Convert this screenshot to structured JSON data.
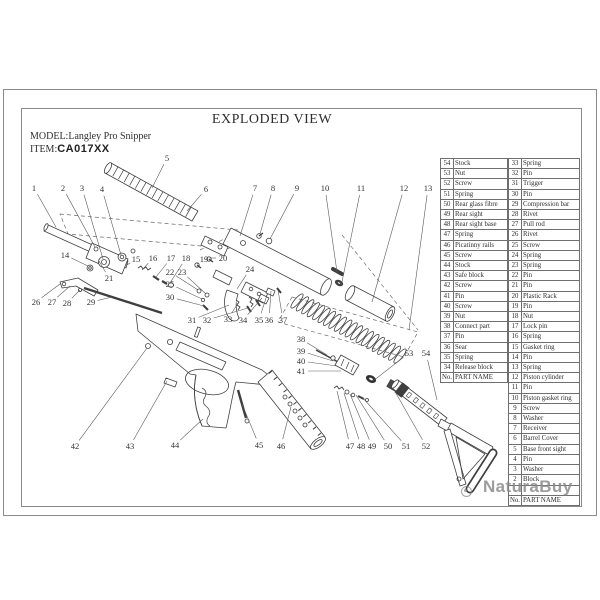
{
  "page": {
    "title": "EXPLODED VIEW",
    "model_label": "MODEL:",
    "model_value": "Langley Pro Snipper",
    "item_label": "ITEM:",
    "item_value": "CA017XX",
    "watermark": "NaturaBuy"
  },
  "colors": {
    "drawing_line": "#3f3f3f",
    "leader_line": "#5a5a5a",
    "table_border": "#6f6f6f",
    "watermark_gray": "#868686"
  },
  "parts_table": {
    "header": {
      "no": "No.",
      "name": "PART NAME"
    },
    "left_rows": [
      {
        "no": "54",
        "name": "Stock"
      },
      {
        "no": "53",
        "name": "Nut"
      },
      {
        "no": "52",
        "name": "Screw"
      },
      {
        "no": "51",
        "name": "Spring"
      },
      {
        "no": "50",
        "name": "Rear glass fibre"
      },
      {
        "no": "49",
        "name": "Rear sight"
      },
      {
        "no": "48",
        "name": "Rear sight base"
      },
      {
        "no": "47",
        "name": "Spring"
      },
      {
        "no": "46",
        "name": "Picatinny rails"
      },
      {
        "no": "45",
        "name": "Screw"
      },
      {
        "no": "44",
        "name": "Stock"
      },
      {
        "no": "43",
        "name": "Safe block"
      },
      {
        "no": "42",
        "name": "Screw"
      },
      {
        "no": "41",
        "name": "Pin"
      },
      {
        "no": "40",
        "name": "Screw"
      },
      {
        "no": "39",
        "name": "Nut"
      },
      {
        "no": "38",
        "name": "Connect part"
      },
      {
        "no": "37",
        "name": "Pin"
      },
      {
        "no": "36",
        "name": "Sear"
      },
      {
        "no": "35",
        "name": "Spring"
      },
      {
        "no": "34",
        "name": "Release block"
      }
    ],
    "right_rows": [
      {
        "no": "33",
        "name": "Spring"
      },
      {
        "no": "32",
        "name": "Pin"
      },
      {
        "no": "31",
        "name": "Trigger"
      },
      {
        "no": "30",
        "name": "Pin"
      },
      {
        "no": "29",
        "name": "Compression bar"
      },
      {
        "no": "28",
        "name": "Rivet"
      },
      {
        "no": "27",
        "name": "Pull rod"
      },
      {
        "no": "26",
        "name": "Rivet"
      },
      {
        "no": "25",
        "name": "Screw"
      },
      {
        "no": "24",
        "name": "Spring"
      },
      {
        "no": "23",
        "name": "Spring"
      },
      {
        "no": "22",
        "name": "Pin"
      },
      {
        "no": "21",
        "name": "Pin"
      },
      {
        "no": "20",
        "name": "Plastic Rack"
      },
      {
        "no": "19",
        "name": "Pin"
      },
      {
        "no": "18",
        "name": "Nut"
      },
      {
        "no": "17",
        "name": "Lock pin"
      },
      {
        "no": "16",
        "name": "Spring"
      },
      {
        "no": "15",
        "name": "Gasket ring"
      },
      {
        "no": "14",
        "name": "Pin"
      },
      {
        "no": "13",
        "name": "Spring"
      },
      {
        "no": "12",
        "name": "Piston cylinder"
      },
      {
        "no": "11",
        "name": "Pin"
      },
      {
        "no": "10",
        "name": "Piston gasket ring"
      },
      {
        "no": "9",
        "name": "Screw"
      },
      {
        "no": "8",
        "name": "Washer"
      },
      {
        "no": "7",
        "name": "Receiver"
      },
      {
        "no": "6",
        "name": "Barrel Cover"
      },
      {
        "no": "5",
        "name": "Base front sight"
      },
      {
        "no": "4",
        "name": "Pin"
      },
      {
        "no": "3",
        "name": "Washer"
      },
      {
        "no": "2",
        "name": "Block"
      },
      {
        "no": "",
        "name": ""
      }
    ]
  },
  "callouts": [
    {
      "n": "1",
      "x": 34,
      "y": 188,
      "tx": 56,
      "ty": 227
    },
    {
      "n": "2",
      "x": 63,
      "y": 188,
      "tx": 95,
      "ty": 247
    },
    {
      "n": "3",
      "x": 82,
      "y": 188,
      "tx": 103,
      "ty": 259
    },
    {
      "n": "4",
      "x": 102,
      "y": 189,
      "tx": 121,
      "ty": 255
    },
    {
      "n": "5",
      "x": 167,
      "y": 158,
      "tx": 152,
      "ty": 188
    },
    {
      "n": "6",
      "x": 206,
      "y": 189,
      "tx": 187,
      "ty": 211
    },
    {
      "n": "7",
      "x": 255,
      "y": 188,
      "tx": 240,
      "ty": 236
    },
    {
      "n": "8",
      "x": 273,
      "y": 188,
      "tx": 260,
      "ty": 234
    },
    {
      "n": "9",
      "x": 297,
      "y": 188,
      "tx": 270,
      "ty": 239
    },
    {
      "n": "10",
      "x": 325,
      "y": 188,
      "tx": 337,
      "ty": 272
    },
    {
      "n": "11",
      "x": 361,
      "y": 188,
      "tx": 342,
      "ty": 282
    },
    {
      "n": "12",
      "x": 404,
      "y": 188,
      "tx": 372,
      "ty": 302
    },
    {
      "n": "13",
      "x": 428,
      "y": 188,
      "tx": 409,
      "ty": 330
    },
    {
      "n": "14",
      "x": 65,
      "y": 255,
      "tx": 88,
      "ty": 266
    },
    {
      "n": "15",
      "x": 136,
      "y": 259,
      "tx": 127,
      "ty": 265
    },
    {
      "n": "16",
      "x": 153,
      "y": 258,
      "tx": 142,
      "ty": 270
    },
    {
      "n": "17",
      "x": 171,
      "y": 258,
      "tx": 156,
      "ty": 277
    },
    {
      "n": "18",
      "x": 186,
      "y": 258,
      "tx": 170,
      "ty": 283
    },
    {
      "n": "19",
      "x": 204,
      "y": 259,
      "tx": 197,
      "ty": 264
    },
    {
      "n": "20",
      "x": 223,
      "y": 258,
      "tx": 210,
      "ty": 258
    },
    {
      "n": "21",
      "x": 109,
      "y": 278,
      "tx": 99,
      "ty": 261
    },
    {
      "n": "22",
      "x": 170,
      "y": 272,
      "tx": 198,
      "ty": 290
    },
    {
      "n": "23",
      "x": 182,
      "y": 272,
      "tx": 206,
      "ty": 294
    },
    {
      "n": "24",
      "x": 250,
      "y": 269,
      "tx": 237,
      "ty": 289
    },
    {
      "n": "25",
      "x": 170,
      "y": 284,
      "tx": 202,
      "ty": 299
    },
    {
      "n": "26",
      "x": 36,
      "y": 302,
      "tx": 60,
      "ty": 284
    },
    {
      "n": "27",
      "x": 52,
      "y": 302,
      "tx": 70,
      "ty": 286
    },
    {
      "n": "28",
      "x": 67,
      "y": 303,
      "tx": 80,
      "ty": 290
    },
    {
      "n": "29",
      "x": 91,
      "y": 302,
      "tx": 112,
      "ty": 297
    },
    {
      "n": "30",
      "x": 170,
      "y": 297,
      "tx": 204,
      "ty": 306
    },
    {
      "n": "31",
      "x": 192,
      "y": 320,
      "tx": 229,
      "ty": 305
    },
    {
      "n": "32",
      "x": 207,
      "y": 320,
      "tx": 248,
      "ty": 308
    },
    {
      "n": "33",
      "x": 228,
      "y": 319,
      "tx": 238,
      "ty": 303
    },
    {
      "n": "34",
      "x": 243,
      "y": 320,
      "tx": 262,
      "ty": 298
    },
    {
      "n": "35",
      "x": 259,
      "y": 320,
      "tx": 267,
      "ty": 295
    },
    {
      "n": "36",
      "x": 269,
      "y": 320,
      "tx": 271,
      "ty": 291
    },
    {
      "n": "37",
      "x": 283,
      "y": 320,
      "tx": 278,
      "ty": 290
    },
    {
      "n": "38",
      "x": 301,
      "y": 339,
      "tx": 327,
      "ty": 355
    },
    {
      "n": "39",
      "x": 301,
      "y": 351,
      "tx": 333,
      "ty": 361
    },
    {
      "n": "40",
      "x": 301,
      "y": 361,
      "tx": 337,
      "ty": 366
    },
    {
      "n": "41",
      "x": 301,
      "y": 371,
      "tx": 341,
      "ty": 371
    },
    {
      "n": "42",
      "x": 75,
      "y": 446,
      "tx": 147,
      "ty": 348
    },
    {
      "n": "43",
      "x": 130,
      "y": 446,
      "tx": 167,
      "ty": 381
    },
    {
      "n": "44",
      "x": 175,
      "y": 445,
      "tx": 203,
      "ty": 419
    },
    {
      "n": "45",
      "x": 259,
      "y": 445,
      "tx": 242,
      "ty": 404
    },
    {
      "n": "46",
      "x": 281,
      "y": 446,
      "tx": 291,
      "ty": 407
    },
    {
      "n": "47",
      "x": 350,
      "y": 446,
      "tx": 337,
      "ty": 391
    },
    {
      "n": "48",
      "x": 361,
      "y": 446,
      "tx": 344,
      "ty": 393
    },
    {
      "n": "49",
      "x": 372,
      "y": 446,
      "tx": 350,
      "ty": 394
    },
    {
      "n": "50",
      "x": 388,
      "y": 446,
      "tx": 356,
      "ty": 395
    },
    {
      "n": "51",
      "x": 406,
      "y": 446,
      "tx": 362,
      "ty": 397
    },
    {
      "n": "52",
      "x": 426,
      "y": 446,
      "tx": 393,
      "ty": 388
    },
    {
      "n": "53",
      "x": 409,
      "y": 353,
      "tx": 373,
      "ty": 381
    },
    {
      "n": "54",
      "x": 426,
      "y": 353,
      "tx": 437,
      "ty": 400
    }
  ]
}
